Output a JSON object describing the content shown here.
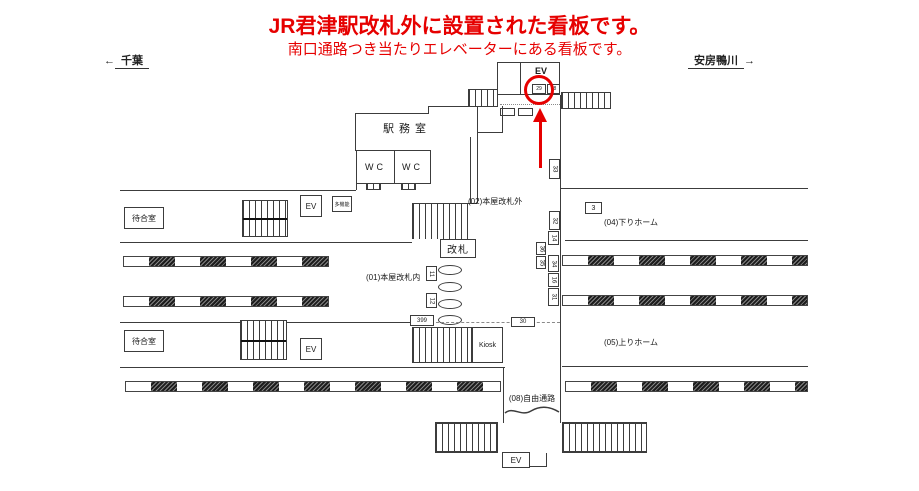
{
  "annotation": {
    "title_line1": "JR君津駅改札外に設置された看板です。",
    "title_line2": "南口通路つき当たりエレベーターにある看板です。",
    "accent_color": "#e60000"
  },
  "directions": {
    "west": "千葉",
    "east": "安房鴨川",
    "west_arrow": "←",
    "east_arrow": "→"
  },
  "rooms": {
    "station_office": "駅務室",
    "wc_left": "WC",
    "wc_right": "WC",
    "waiting_upper": "待合室",
    "waiting_lower": "待合室",
    "ticket_gate": "改札",
    "kiosk": "Kiosk",
    "multifunction_toilet": "多機能",
    "ev_north": "EV",
    "ev_upper_left": "EV",
    "ev_lower_left": "EV",
    "ev_south": "EV"
  },
  "areas": {
    "inside_gate": "(01)本屋改札内",
    "outside_gate": "(02)本屋改札外",
    "down_platform": "(04)下りホーム",
    "up_platform": "(05)上りホーム",
    "free_passage": "(08)自由通路"
  },
  "sign_numbers": {
    "north_left": "29",
    "north_right": "28",
    "s3": "3",
    "s11": "11",
    "s12": "12",
    "s14": "14",
    "s16": "16",
    "s30": "30",
    "s31": "31",
    "s32": "32",
    "s33": "33",
    "s34": "34",
    "s35": "35",
    "s36": "36",
    "s399": "399"
  }
}
